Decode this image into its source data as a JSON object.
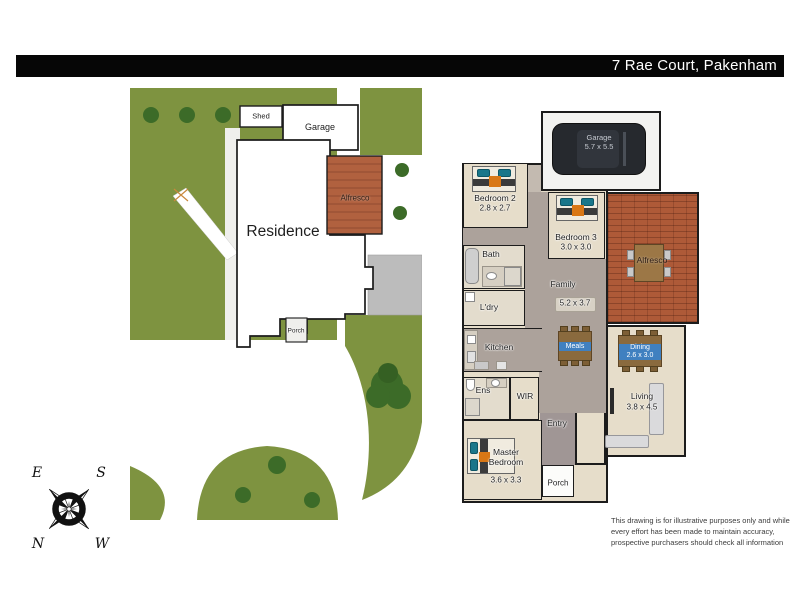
{
  "title_bar": {
    "address": "7 Rae Court, Pakenham"
  },
  "site_plan": {
    "shed_label": "Shed",
    "garage_label": "Garage",
    "residence_label": "Residence",
    "alfresco_label": "Alfresco",
    "porch_label": "Porch"
  },
  "floor_plan": {
    "rooms": {
      "garage": {
        "name": "Garage",
        "dims": "5.7 x 5.5"
      },
      "bedroom2": {
        "name": "Bedroom 2",
        "dims": "2.8 x 2.7"
      },
      "bedroom3": {
        "name": "Bedroom 3",
        "dims": "3.0 x 3.0"
      },
      "bath": {
        "name": "Bath"
      },
      "laundry": {
        "name": "L'dry"
      },
      "family": {
        "name": "Family",
        "dims": "5.2 x 3.7"
      },
      "kitchen": {
        "name": "Kitchen"
      },
      "meals": {
        "name": "Meals"
      },
      "dining": {
        "name": "Dining",
        "dims": "2.6 x 3.0"
      },
      "living": {
        "name": "Living",
        "dims": "3.8 x 4.5"
      },
      "ensuite": {
        "name": "Ens"
      },
      "wir": {
        "name": "WIR"
      },
      "entry": {
        "name": "Entry"
      },
      "master": {
        "name": "Master Bedroom",
        "dims": "3.6 x 3.3"
      },
      "alfresco": {
        "name": "Alfresco"
      },
      "porch": {
        "name": "Porch"
      }
    }
  },
  "compass": {
    "n": "N",
    "s": "S",
    "e": "E",
    "w": "W"
  },
  "disclaimer": {
    "line1": "This drawing is for illustrative purposes only and while",
    "line2": "every effort has been made to maintain accuracy,",
    "line3": "prospective purchasers should check all information"
  },
  "colors": {
    "grass": "#7e9340",
    "tree": "#3c6b28",
    "brick": "#ae5a38",
    "wall": "#1c1c1c",
    "floor_beige": "#e6ddca",
    "floor_gray": "#aca29b",
    "entry_gray": "#a09695",
    "accent_blue": "#4080c0",
    "pillow_teal": "#19768a",
    "blanket_orange": "#d97715",
    "car": "#26292e",
    "concrete_pad": "#bcbcbc"
  }
}
